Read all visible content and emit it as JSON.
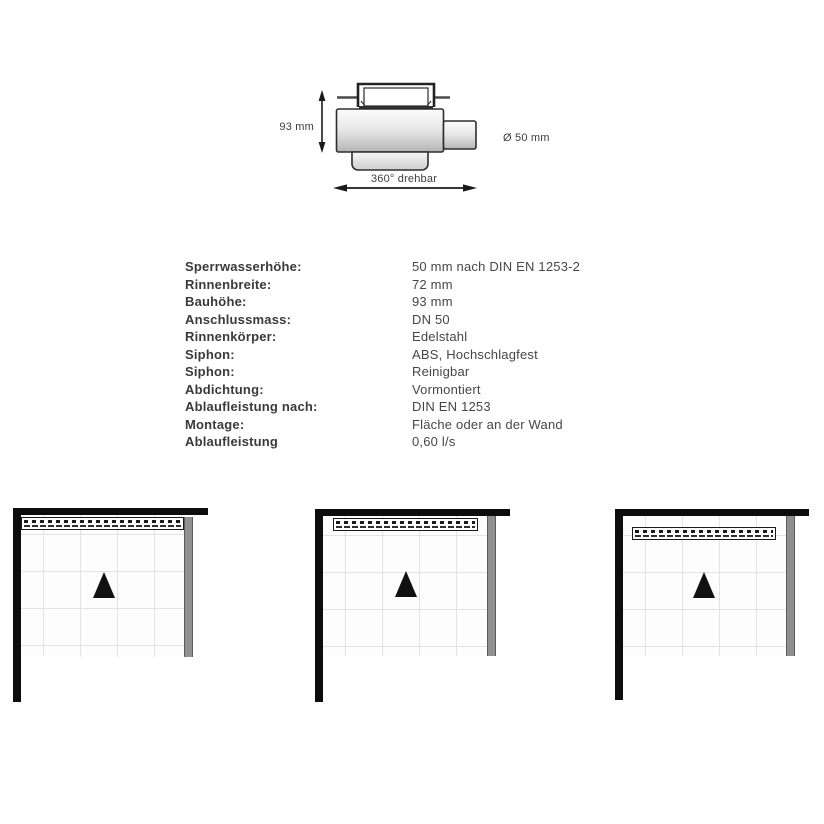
{
  "drawing": {
    "height_label": "93 mm",
    "diameter_label": "Ø 50 mm",
    "rotation_label": "360° drehbar"
  },
  "specs": {
    "rows": [
      {
        "label": "Sperrwasserhöhe:",
        "value": "50 mm nach DIN EN 1253-2"
      },
      {
        "label": "Rinnenbreite:",
        "value": "72 mm"
      },
      {
        "label": "Bauhöhe:",
        "value": "93 mm"
      },
      {
        "label": "Anschlussmass:",
        "value": "DN 50"
      },
      {
        "label": "Rinnenkörper:",
        "value": "Edelstahl"
      },
      {
        "label": "Siphon:",
        "value": "ABS, Hochschlagfest"
      },
      {
        "label": "Siphon:",
        "value": "Reinigbar"
      },
      {
        "label": "Abdichtung:",
        "value": "Vormontiert"
      },
      {
        "label": "Ablaufleistung nach:",
        "value": "DIN EN 1253"
      },
      {
        "label": "Montage:",
        "value": "Fläche oder an der Wand"
      },
      {
        "label": "Ablaufleistung",
        "value": "0,60 l/s"
      }
    ]
  },
  "colors": {
    "wall": "#0d0d0d",
    "glass": "#8f8f8f",
    "text": "#3e3e3e",
    "grid_line": "#e3e3e3",
    "triangle": "#111111"
  }
}
